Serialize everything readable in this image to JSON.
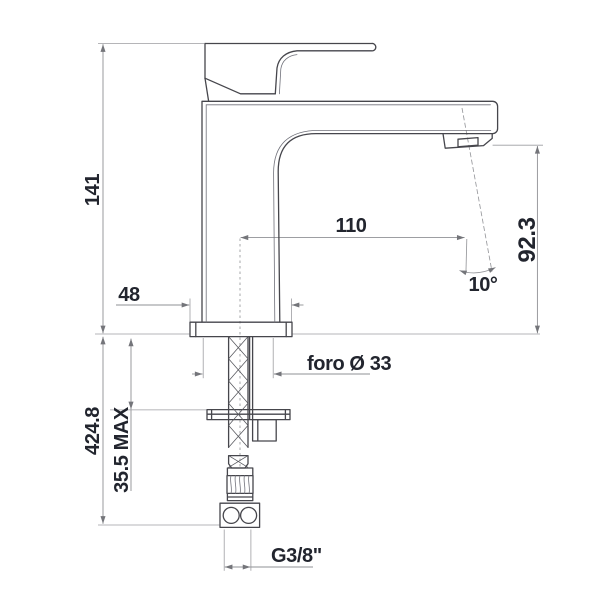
{
  "drawing": {
    "kind": "technical dimension drawing",
    "subject": "single-lever basin mixer tap, side view with below-deck mounting parts and flexible supply hose",
    "units": "mm",
    "colors": {
      "outline": "#46464c",
      "inner_line": "#70717a",
      "dimension_line": "#8f9094",
      "extension_line": "#9c9da1",
      "arrow": "#74757a",
      "text": "#22252e",
      "background": "#ffffff"
    },
    "labels": {
      "height_above_deck": "141",
      "length_below_deck": "424.8",
      "max_deck_thickness": "35.5 MAX",
      "base_width": "48",
      "spout_reach": "110",
      "outlet_height": "92.3",
      "outlet_angle": "10°",
      "mounting_hole": "foro Ø 33",
      "supply_connection": "G3/8\""
    }
  }
}
